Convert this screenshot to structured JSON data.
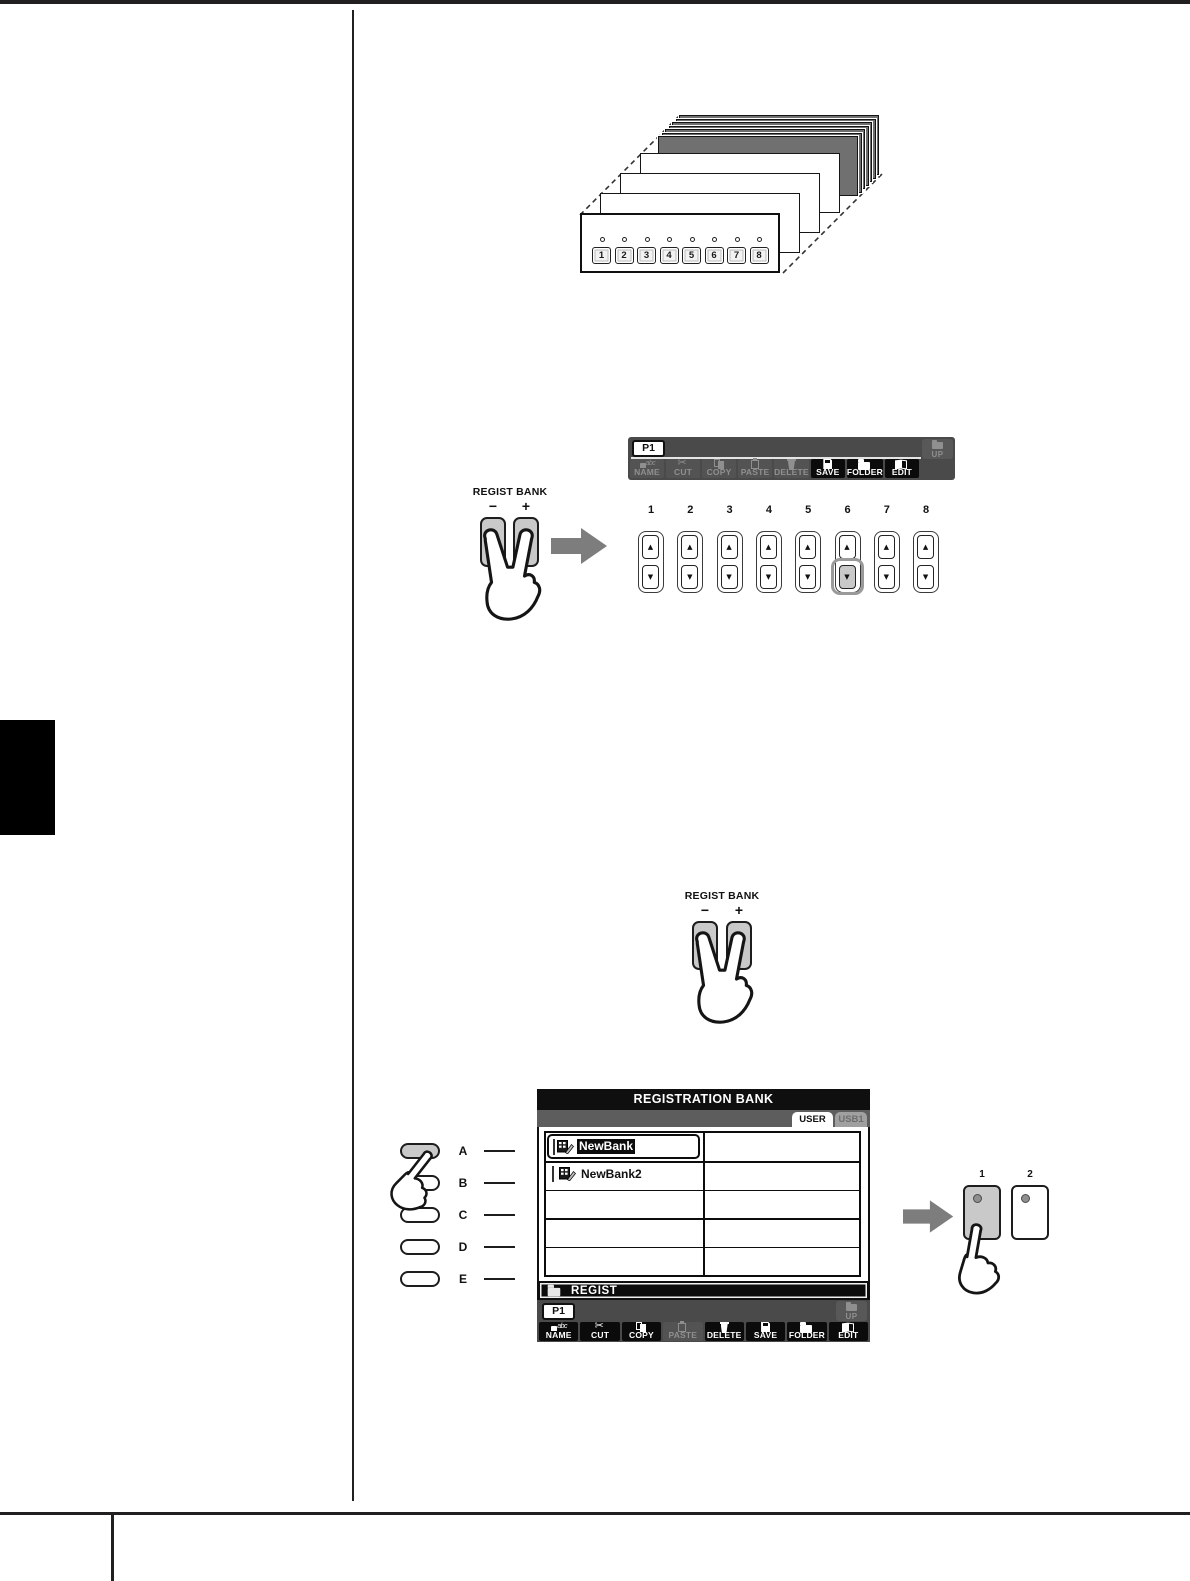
{
  "stack": {
    "numbers": [
      "1",
      "2",
      "3",
      "4",
      "5",
      "6",
      "7",
      "8"
    ]
  },
  "file_toolbar": {
    "page_tab": "P1",
    "up_label": "UP",
    "buttons": [
      {
        "label": "NAME"
      },
      {
        "label": "CUT"
      },
      {
        "label": "COPY"
      },
      {
        "label": "PASTE"
      },
      {
        "label": "DELETE"
      },
      {
        "label": "SAVE"
      },
      {
        "label": "FOLDER"
      },
      {
        "label": "EDIT"
      }
    ]
  },
  "regist_bank": {
    "label": "REGIST BANK",
    "minus": "−",
    "plus": "+"
  },
  "memory_row": {
    "numbers": [
      "1",
      "2",
      "3",
      "4",
      "5",
      "6",
      "7",
      "8"
    ],
    "up_glyph": "▲",
    "down_glyph": "▼",
    "highlighted_number": "6"
  },
  "screen": {
    "title": "REGISTRATION BANK",
    "tabs": [
      {
        "label": "USER"
      },
      {
        "label": "USB1"
      }
    ],
    "selected_tab": "USER",
    "files": [
      {
        "name": "NewBank"
      },
      {
        "name": "NewBank2"
      }
    ],
    "path": "REGIST",
    "page_tab": "P1",
    "up_label": "UP",
    "buttons": [
      {
        "label": "NAME"
      },
      {
        "label": "CUT"
      },
      {
        "label": "COPY"
      },
      {
        "label": "PASTE"
      },
      {
        "label": "DELETE"
      },
      {
        "label": "SAVE"
      },
      {
        "label": "FOLDER"
      },
      {
        "label": "EDIT"
      }
    ]
  },
  "display_select": {
    "labels": [
      "A",
      "B",
      "C",
      "D",
      "E"
    ],
    "pressed": "A"
  },
  "regist_memory": {
    "labels": [
      "1",
      "2"
    ],
    "pressed": "1"
  },
  "colors": {
    "rule": "#221f20",
    "toolbar_bg": "#4a4a4a",
    "active_button": "#0b0b0b",
    "disabled_text": "#8f8f8f",
    "pressed_button": "#c9c9c9",
    "arrow_gray": "#7d7d7d"
  }
}
